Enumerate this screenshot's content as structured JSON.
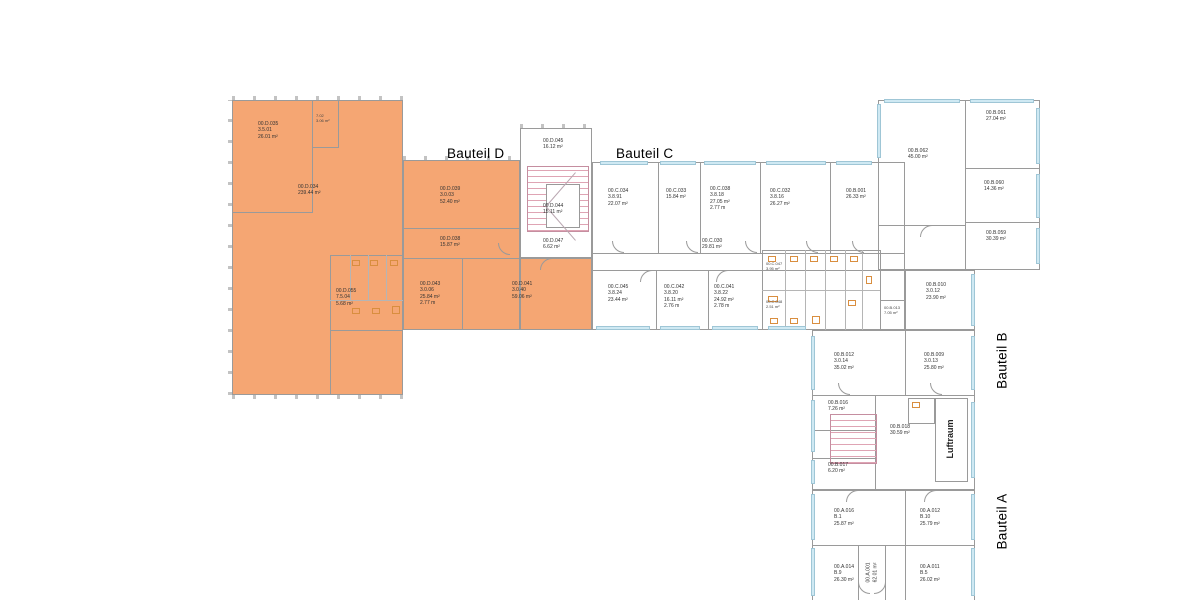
{
  "labels": {
    "bauteil_d": "Bauteil D",
    "bauteil_c": "Bauteil C",
    "bauteil_b": "Bauteil B",
    "bauteil_a": "Bauteil A",
    "luftraum": "Luftraum"
  },
  "colors": {
    "highlight": "#f5a673",
    "window": "#cfe9f3",
    "stair": "#dfa4b4",
    "fixture": "#d98e3f",
    "wall": "#9a9a9a"
  },
  "rooms": {
    "d": [
      {
        "text": "00.D.035\n3.5.01\n26.01 m²"
      },
      {
        "text": "7.02\n3.06 m²"
      },
      {
        "text": "00.D.034\n239.44 m²"
      },
      {
        "text": "00.D.039\n3.0.03\n52.40 m²"
      },
      {
        "text": "00.D.038\n15.87 m²"
      },
      {
        "text": "00.D.055\n7.5.04\n5.68 m²"
      },
      {
        "text": "00.D.043\n3.0.06\n25.84 m²\n2.77 m"
      },
      {
        "text": "00.D.041\n3.0.40\n59.06 m²"
      },
      {
        "text": "00.D.045\n16.12 m²"
      },
      {
        "text": "00.D.044\n15.11 m²"
      },
      {
        "text": "00.D.047\n6.62 m²"
      }
    ],
    "c": [
      {
        "text": "00.C.034\n3.8.91\n22.07 m²"
      },
      {
        "text": "00.C.033\n15.84 m²"
      },
      {
        "text": "00.C.038\n3.8.18\n27.05 m²\n2.77 m"
      },
      {
        "text": "00.C.032\n3.8.16\n26.27 m²"
      },
      {
        "text": "00.B.001\n26.33 m²"
      },
      {
        "text": "00.C.030\n29.81 m²"
      },
      {
        "text": "00.C.045\n3.8.24\n23.44 m²"
      },
      {
        "text": "00.C.042\n3.8.20\n16.11 m²\n2.76 m"
      },
      {
        "text": "00.C.041\n3.8.22\n24.92 m²\n2.78 m"
      },
      {
        "text": "00.C.047\n3.95 m²"
      },
      {
        "text": "00.C.048\n2.51 m²"
      },
      {
        "text": "00.B.013\n7.05 m²"
      }
    ],
    "b": [
      {
        "text": "00.B.062\n45.00 m²"
      },
      {
        "text": "00.B.061\n27.04 m²"
      },
      {
        "text": "00.B.060\n14.36 m²"
      },
      {
        "text": "00.B.059\n30.39 m²"
      },
      {
        "text": "00.B.010\n3.0.12\n23.90 m²"
      },
      {
        "text": "00.B.012\n3.0.14\n35.02 m²"
      },
      {
        "text": "00.B.009\n3.0.13\n25.80 m²"
      },
      {
        "text": "00.B.016\n7.26 m²"
      },
      {
        "text": "00.B.018\n30.59 m²"
      },
      {
        "text": "00.B.017\n6.20 m²"
      }
    ],
    "a": [
      {
        "text": "00.A.016\nB.1\n25.87 m²"
      },
      {
        "text": "00.A.012\nB.10\n25.79 m²"
      },
      {
        "text": "00.A.014\nB.9\n26.30 m²"
      },
      {
        "text": "00.A.011\nB.5\n26.02 m²"
      },
      {
        "text": "00.A.001\n62.01 m²"
      }
    ]
  }
}
